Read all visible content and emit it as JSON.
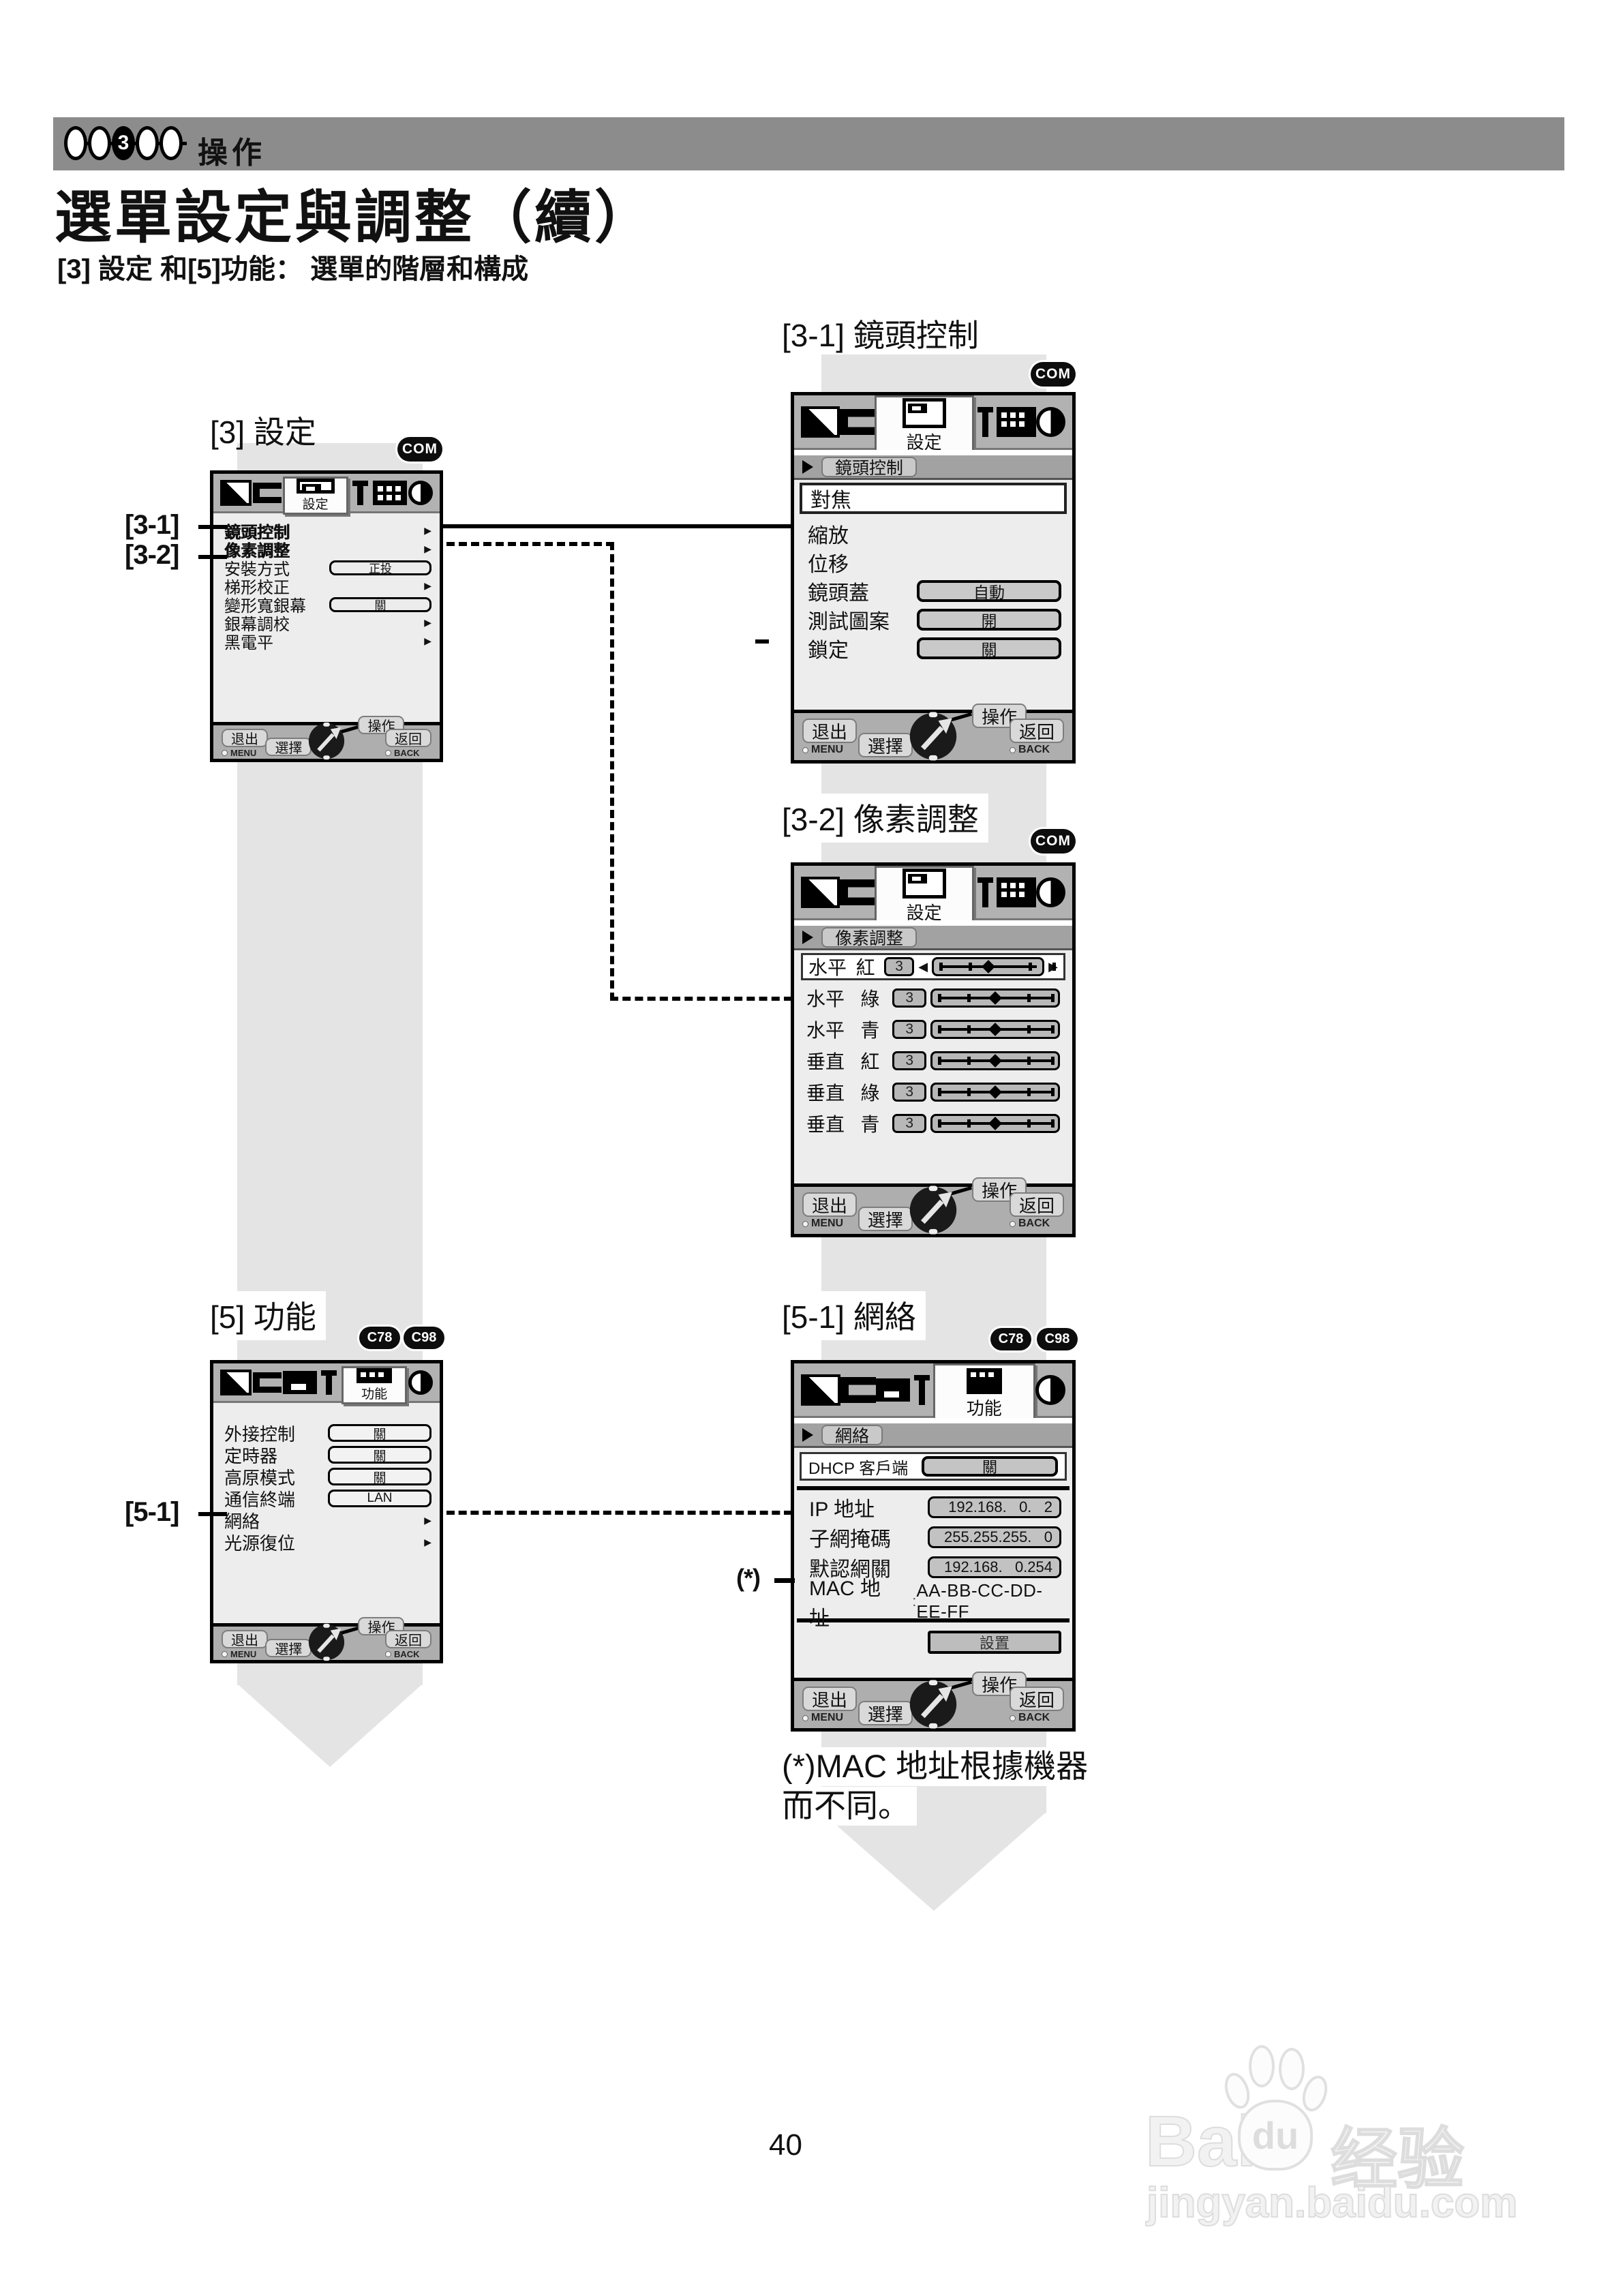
{
  "header": {
    "section_label": "操作",
    "step_current": "3"
  },
  "title": "選單設定與調整（續）",
  "subtitle": "[3] 設定 和[5]功能： 選單的階層和構成",
  "page_number": "40",
  "badges": {
    "com": "COM",
    "c78": "C78",
    "c98": "C98"
  },
  "controls": {
    "exit": "退出",
    "exit_key": "MENU",
    "select": "選擇",
    "operate": "操作",
    "back": "返回",
    "back_key": "BACK"
  },
  "callouts": {
    "c31": "[3-1]",
    "c32": "[3-2]",
    "c51": "[5-1]",
    "star": "(*)"
  },
  "menu3": {
    "title": "[3] 設定",
    "tab": "設定",
    "items": [
      {
        "label": "鏡頭控制"
      },
      {
        "label": "像素調整"
      },
      {
        "label": "安裝方式",
        "value": "正投"
      },
      {
        "label": "梯形校正"
      },
      {
        "label": "變形寬銀幕",
        "value": "關"
      },
      {
        "label": "銀幕調校"
      },
      {
        "label": "黑電平"
      }
    ]
  },
  "menu31": {
    "title": "[3-1] 鏡頭控制",
    "tab": "設定",
    "breadcrumb": "鏡頭控制",
    "items": [
      {
        "label": "對焦"
      },
      {
        "label": "縮放"
      },
      {
        "label": "位移"
      },
      {
        "label": "鏡頭蓋",
        "value": "自動"
      },
      {
        "label": "測試圖案",
        "value": "開"
      },
      {
        "label": "鎖定",
        "value": "關"
      }
    ]
  },
  "menu32": {
    "title": "[3-2] 像素調整",
    "tab": "設定",
    "breadcrumb": "像素調整",
    "rows": [
      {
        "axis": "水平",
        "color": "紅",
        "value": "3"
      },
      {
        "axis": "水平",
        "color": "綠",
        "value": "3"
      },
      {
        "axis": "水平",
        "color": "青",
        "value": "3"
      },
      {
        "axis": "垂直",
        "color": "紅",
        "value": "3"
      },
      {
        "axis": "垂直",
        "color": "綠",
        "value": "3"
      },
      {
        "axis": "垂直",
        "color": "青",
        "value": "3"
      }
    ]
  },
  "menu5": {
    "title": "[5] 功能",
    "tab": "功能",
    "items": [
      {
        "label": "外接控制",
        "value": "關"
      },
      {
        "label": "定時器",
        "value": "關"
      },
      {
        "label": "高原模式",
        "value": "關"
      },
      {
        "label": "通信終端",
        "value": "LAN"
      },
      {
        "label": "網絡"
      },
      {
        "label": "光源復位"
      }
    ]
  },
  "menu51": {
    "title": "[5-1] 網絡",
    "tab": "功能",
    "breadcrumb": "網絡",
    "dhcp_label": "DHCP 客戶端",
    "dhcp_value": "關",
    "rows": [
      {
        "label": "IP 地址",
        "value": "192.168.   0.   2"
      },
      {
        "label": "子網掩碼",
        "value": "255.255.255.   0"
      },
      {
        "label": "默認網關",
        "value": "192.168.   0.254"
      }
    ],
    "mac_label": "MAC 地址",
    "mac_sep": ":",
    "mac_value": "AA-BB-CC-DD-EE-FF",
    "set_button": "設置"
  },
  "footnote": {
    "line1": "(*)MAC 地址根據機器",
    "line2": "而不同。"
  },
  "watermark": {
    "brand_prefix": "Bai",
    "paw_text": "du",
    "brand_cn": "经验",
    "url": "jingyan.baidu.com"
  }
}
